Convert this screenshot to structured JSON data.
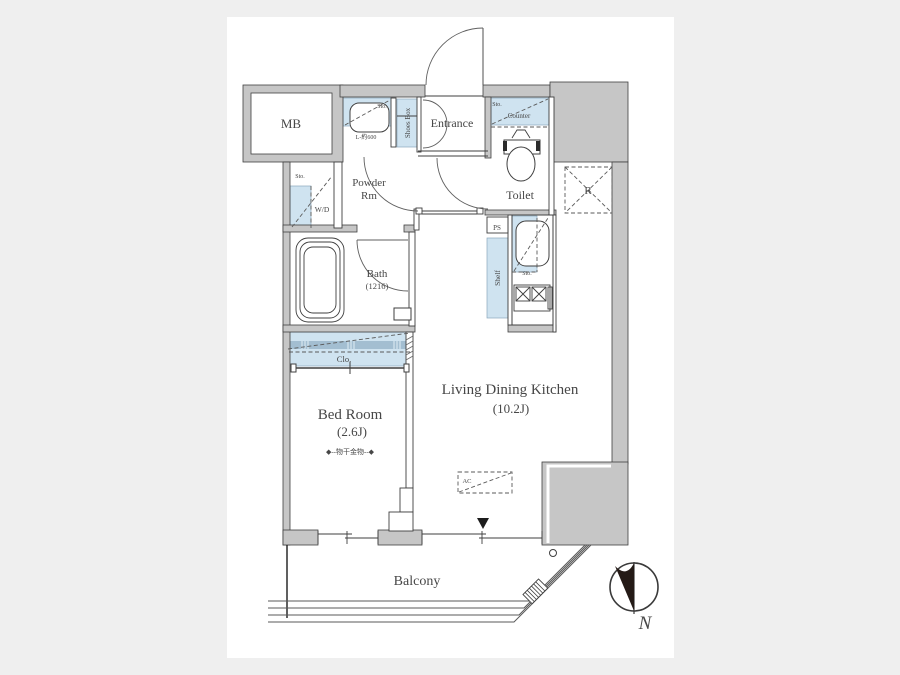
{
  "window": {
    "background": "#efefef",
    "canvas_background": "#ffffff"
  },
  "floorplan": {
    "labels": {
      "mb": "MB",
      "entrance": "Entrance",
      "shoes_box": "Shoes Box",
      "powder_room_line1": "Powder",
      "powder_room_line2": "Rm",
      "toilet": "Toilet",
      "bath": "Bath",
      "bath_size": "(1216)",
      "bedroom": "Bed Room",
      "bedroom_size": "(2.6J)",
      "laundry_fixture": "◆--物干金物--◆",
      "ldk": "Living Dining Kitchen",
      "ldk_size": "(10.2J)",
      "balcony": "Balcony",
      "washer_dryer": "W/D",
      "refrigerator": "R",
      "pipe_space": "PS",
      "shelf": "Shelf",
      "closet": "Clo.",
      "counter": "Counter",
      "storage": "Sto.",
      "air_conditioner": "AC",
      "basin_width": "L-約600",
      "north": "N"
    },
    "colors": {
      "wall_fill": "#c6c6c6",
      "storage_highlight": "#cfe3f0",
      "closet_stripe": "#a3bed1",
      "line": "#3f3f3f",
      "page_background": "#efefef",
      "north_arrow_fill": "#241a16"
    }
  }
}
